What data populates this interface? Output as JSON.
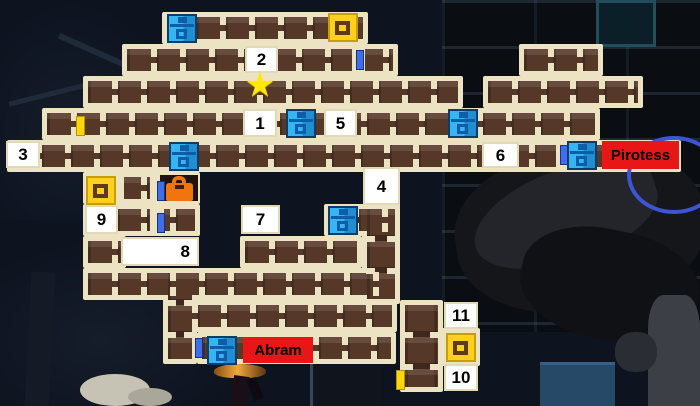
{
  "title": "Dungeon map overlay with numbered rooms",
  "colors": {
    "map_wall_cream": "#ece3c2",
    "map_floor_brown": "#563829",
    "room_white": "#ffffff",
    "npc_label_red": "#e81616",
    "chest_blue": "#2aa7e0",
    "chest_gold": "#fcd01d",
    "door_blue": "#3f6ee8",
    "door_yellow": "#ffd60a",
    "star_yellow": "#ffe70a",
    "magic_circle_blue": "#3c55d4",
    "background_dark": "#0d1420"
  },
  "map": {
    "segments": [
      {
        "dir": "h",
        "rect": [
          162,
          12,
          206,
          32
        ]
      },
      {
        "dir": "h",
        "rect": [
          122,
          44,
          276,
          32
        ]
      },
      {
        "dir": "h",
        "rect": [
          519,
          44,
          84,
          32
        ]
      },
      {
        "dir": "h",
        "rect": [
          83,
          76,
          380,
          32
        ]
      },
      {
        "dir": "h",
        "rect": [
          483,
          76,
          160,
          32
        ]
      },
      {
        "dir": "h",
        "rect": [
          42,
          108,
          558,
          32
        ]
      },
      {
        "dir": "h",
        "rect": [
          7,
          140,
          674,
          32
        ]
      },
      {
        "dir": "h",
        "rect": [
          83,
          172,
          117,
          32
        ]
      },
      {
        "dir": "h",
        "rect": [
          83,
          204,
          117,
          32
        ]
      },
      {
        "dir": "h",
        "rect": [
          324,
          204,
          76,
          32
        ]
      },
      {
        "dir": "h",
        "rect": [
          83,
          236,
          43,
          32
        ]
      },
      {
        "dir": "h",
        "rect": [
          240,
          236,
          122,
          32
        ]
      },
      {
        "dir": "h",
        "rect": [
          83,
          268,
          314,
          32
        ]
      },
      {
        "dir": "h",
        "rect": [
          163,
          300,
          234,
          32
        ]
      },
      {
        "dir": "v",
        "rect": [
          362,
          204,
          38,
          100
        ]
      },
      {
        "dir": "v",
        "rect": [
          163,
          268,
          34,
          96
        ]
      },
      {
        "dir": "h",
        "rect": [
          197,
          332,
          199,
          32
        ]
      },
      {
        "dir": "v",
        "rect": [
          400,
          300,
          43,
          92
        ]
      }
    ],
    "walls": [
      [
        352,
        44,
        13,
        32
      ],
      [
        150,
        172,
        14,
        32
      ],
      [
        150,
        204,
        14,
        32
      ],
      [
        556,
        140,
        13,
        32
      ],
      [
        116,
        172,
        8,
        32
      ]
    ],
    "dark_cells": [
      [
        160,
        175,
        38,
        26
      ]
    ],
    "cream_cells": [
      [
        440,
        328,
        40,
        38
      ]
    ],
    "rooms": [
      {
        "label": "2",
        "rect": [
          245,
          46,
          33,
          27
        ]
      },
      {
        "label": "1",
        "rect": [
          243,
          109,
          34,
          28
        ]
      },
      {
        "label": "5",
        "rect": [
          324,
          109,
          33,
          28
        ]
      },
      {
        "label": "3",
        "rect": [
          6,
          141,
          34,
          27
        ]
      },
      {
        "label": "6",
        "rect": [
          482,
          142,
          37,
          26
        ]
      },
      {
        "label": "4",
        "rect": [
          363,
          167,
          37,
          38
        ]
      },
      {
        "label": "7",
        "rect": [
          241,
          205,
          39,
          29
        ]
      },
      {
        "label": "9",
        "rect": [
          85,
          205,
          33,
          29
        ]
      },
      {
        "label": "8",
        "rect": [
          121,
          237,
          78,
          29
        ],
        "align": "right"
      },
      {
        "label": "11",
        "rect": [
          444,
          302,
          34,
          27
        ]
      },
      {
        "label": "10",
        "rect": [
          444,
          364,
          34,
          27
        ]
      }
    ],
    "npcs": [
      {
        "label": "Pirotess",
        "rect": [
          602,
          141,
          77,
          28
        ]
      },
      {
        "label": "Abram",
        "rect": [
          243,
          337,
          70,
          26
        ]
      }
    ],
    "markers": {
      "star": {
        "glyph": "★",
        "rect": [
          243,
          70,
          34,
          34
        ]
      },
      "blue_chests": [
        [
          167,
          14
        ],
        [
          286,
          109
        ],
        [
          448,
          109
        ],
        [
          169,
          142
        ],
        [
          567,
          141
        ],
        [
          328,
          206
        ],
        [
          207,
          336
        ]
      ],
      "gold_chests": [
        [
          328,
          13
        ],
        [
          86,
          176
        ],
        [
          446,
          333
        ]
      ],
      "blue_doors": [
        [
          356,
          50
        ],
        [
          157,
          181
        ],
        [
          157,
          213
        ],
        [
          560,
          145
        ],
        [
          195,
          338
        ]
      ],
      "yellow_doors": [
        [
          76,
          116
        ],
        [
          396,
          370
        ]
      ],
      "bag": {
        "rect": [
          164,
          176,
          32,
          26
        ]
      }
    }
  }
}
